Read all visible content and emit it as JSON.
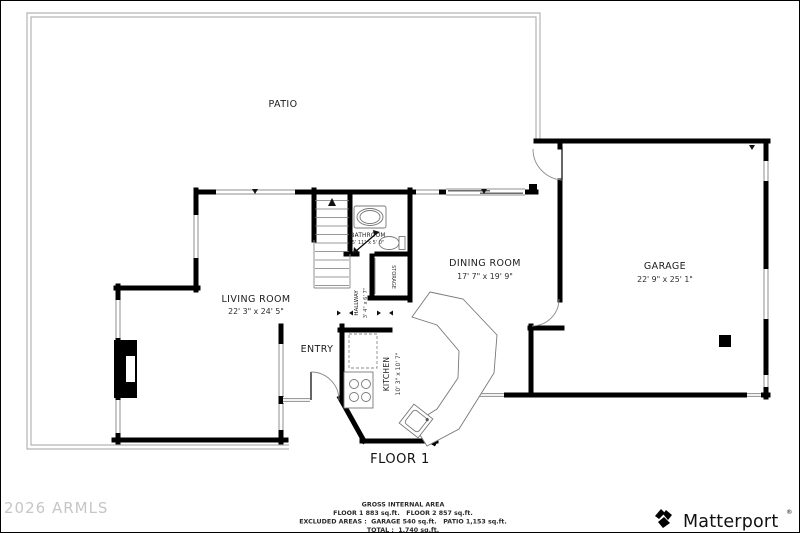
{
  "plan": {
    "floor_label": "FLOOR 1",
    "rooms": {
      "patio": {
        "name": "PATIO"
      },
      "living": {
        "name": "LIVING ROOM",
        "dims": "22' 3\" x 24' 5\""
      },
      "dining": {
        "name": "DINING ROOM",
        "dims": "17' 7\" x 19' 9\""
      },
      "garage": {
        "name": "GARAGE",
        "dims": "22' 9\" x 25' 1\""
      },
      "kitchen": {
        "name": "KITCHEN",
        "dims": "10' 3\" x 10' 7\""
      },
      "bathroom": {
        "name": "BATHROOM",
        "dims": "5' 11\" x 5' 0\""
      },
      "hallway": {
        "name": "HALLWAY",
        "dims": "3' 4\" x 6' 7\""
      },
      "storage": {
        "name": "STORAGE"
      },
      "entry": {
        "name": "ENTRY"
      }
    }
  },
  "footer": {
    "summary": {
      "title": "GROSS INTERNAL AREA",
      "line1": "FLOOR 1 883 sq.ft.   FLOOR 2 857 sq.ft.",
      "line2": "EXCLUDED AREAS :  GARAGE 540 sq.ft.   PATIO 1,153 sq.ft.",
      "line3": "TOTAL :  1,740 sq.ft."
    },
    "watermark": "2026 ARMLS",
    "brand": "Matterport",
    "brand_mark": "®"
  },
  "colors": {
    "wall": "#000000",
    "thin_line": "#8f8f8f",
    "watermark": "#c6c6c6"
  }
}
